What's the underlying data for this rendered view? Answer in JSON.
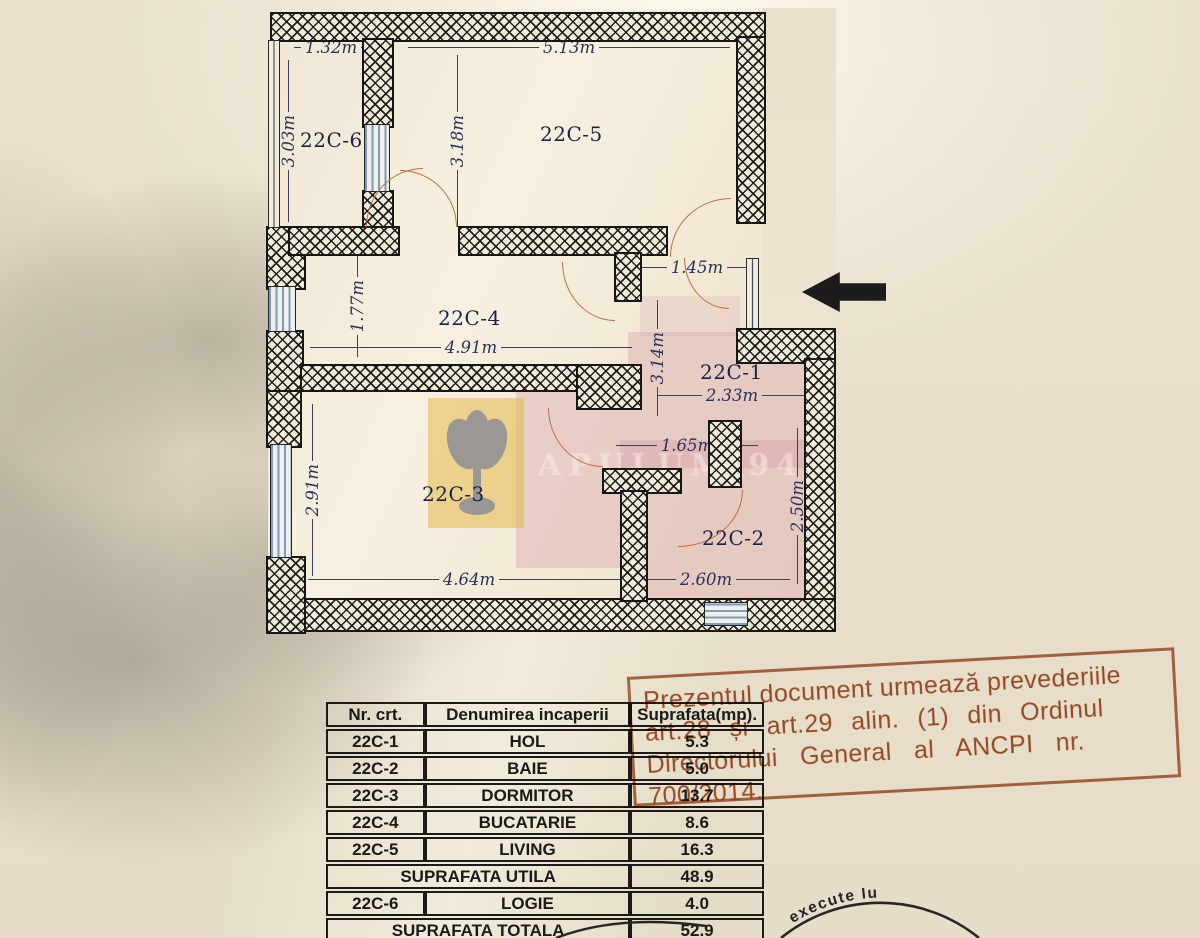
{
  "floor_plan": {
    "room_labels": [
      "22C-6",
      "22C-5",
      "22C-4",
      "22C-1",
      "22C-3",
      "22C-2"
    ],
    "dimensions": [
      "1.32m",
      "5.13m",
      "3.03m",
      "3.18m",
      "1.77m",
      "4.91m",
      "1.45m",
      "3.14m",
      "2.33m",
      "1.65m",
      "2.91m",
      "2.50m",
      "4.64m",
      "2.60m"
    ]
  },
  "watermark": {
    "text": "APULUM 94"
  },
  "rect_stamp": {
    "color": "#a8542f",
    "lines": [
      "Prezentul document urmează prevederiile",
      "art.28 și art.29 alin. (1) din Ordinul",
      "Directorului General al ANCPI nr.",
      "700/2014."
    ]
  },
  "round_stamp": {
    "visible_text": "execute lu"
  },
  "table": {
    "headers": [
      "Nr. crt.",
      "Denumirea incaperii",
      "Suprafata(mp)."
    ],
    "rows": [
      {
        "nr": "22C-1",
        "name": "HOL",
        "area": "5.3"
      },
      {
        "nr": "22C-2",
        "name": "BAIE",
        "area": "5.0"
      },
      {
        "nr": "22C-3",
        "name": "DORMITOR",
        "area": "13.7"
      },
      {
        "nr": "22C-4",
        "name": "BUCATARIE",
        "area": "8.6"
      },
      {
        "nr": "22C-5",
        "name": "LIVING",
        "area": "16.3"
      }
    ],
    "utila": {
      "label": "SUPRAFATA UTILA",
      "area": "48.9"
    },
    "logie": {
      "nr": "22C-6",
      "name": "LOGIE",
      "area": "4.0"
    },
    "totala": {
      "label": "SUPRAFATA TOTALA",
      "area": "52.9"
    }
  },
  "colors": {
    "paper": "#e9e1cd",
    "wall_ink": "#161616",
    "door_arc": "#bd6f46",
    "window_blue": "#8299b9",
    "dimension_text": "#2c3158",
    "stamp_orange": "#a8542f",
    "highlight_pink": "#cf8ba0",
    "watermark_yellow": "#e4ba4a"
  }
}
